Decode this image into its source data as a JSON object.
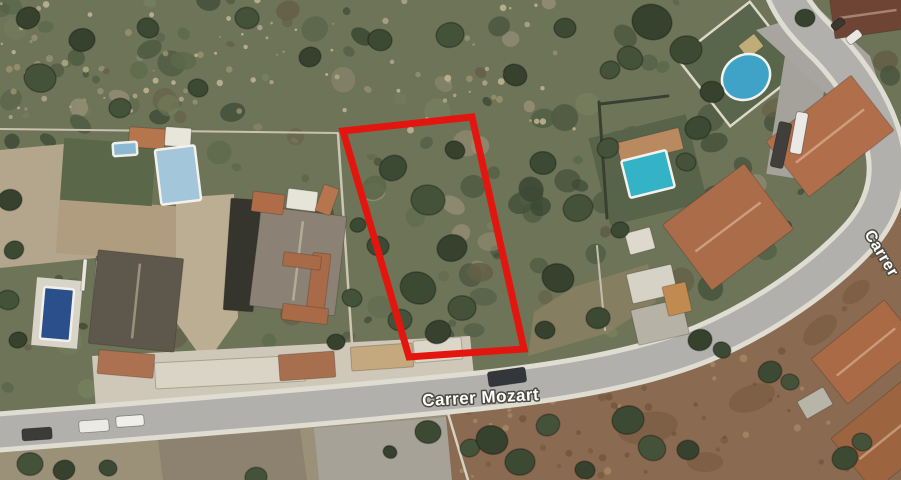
{
  "view": {
    "type": "satellite map view",
    "width": 901,
    "height": 480
  },
  "labels": {
    "road_main": "Carrer Mozart",
    "road_side": "Carrer"
  },
  "palette": {
    "base": "#6e7458",
    "road_fill": "#b1b0ac",
    "road_casing": "#dfdcd2",
    "red_outline": "#e3160f",
    "label_fill": "#ffffff",
    "label_halo": "#4d4a42",
    "blotch": "#6f5539",
    "tree_shades": [
      "#3c4a33",
      "#44523a",
      "#36422e"
    ]
  },
  "texture": {
    "seed": 11,
    "green_blobs": 260,
    "green_palette": [
      "#4e5c42",
      "#45523b",
      "#5b6949",
      "#3b4834",
      "#76805e",
      "#9a9177",
      "#645f47"
    ],
    "rock_speckles": 95,
    "rock_palette": [
      "#b3a78a",
      "#c3b697",
      "#99906f"
    ],
    "dirt_speckles": 85,
    "dirt_palette": [
      "#755a3e",
      "#a98d67",
      "#6d5338"
    ]
  },
  "grounds": [
    {
      "name": "courtyard-left-edge",
      "poly": [
        [
          0,
          150
        ],
        [
          86,
          142
        ],
        [
          96,
          258
        ],
        [
          0,
          268
        ]
      ],
      "fill": "#b3a68c"
    },
    {
      "name": "courtyard-left",
      "rect": [
        120,
        230,
        125,
        55,
        4
      ],
      "fill": "#b09d7f"
    },
    {
      "name": "courtyard-center",
      "poly": [
        [
          176,
          198
        ],
        [
          234,
          194
        ],
        [
          238,
          318
        ],
        [
          206,
          364
        ],
        [
          176,
          322
        ]
      ],
      "fill": "#bcae93"
    },
    {
      "name": "pool-deck-left",
      "rect": [
        57,
        313,
        46,
        68,
        5
      ],
      "fill": "#d8d4c8"
    },
    {
      "name": "lawn-left",
      "rect": [
        108,
        172,
        92,
        62,
        4
      ],
      "fill": "#5a6849"
    },
    {
      "name": "garden-teal-pool",
      "rect": [
        648,
        170,
        100,
        90,
        -14
      ],
      "fill": "#57644a"
    },
    {
      "name": "garden-oval-pool",
      "rect": [
        740,
        64,
        92,
        86,
        -38
      ],
      "fill": "#59664b",
      "stroke": "#ddd8c8",
      "stroke_w": 2.5
    },
    {
      "name": "band-north-of-road",
      "poly": [
        [
          92,
          356
        ],
        [
          470,
          336
        ],
        [
          476,
          396
        ],
        [
          96,
          410
        ]
      ],
      "fill": "#cfc8b8"
    },
    {
      "name": "dirt-south-left",
      "poly": [
        [
          0,
          452
        ],
        [
          155,
          437
        ],
        [
          312,
          426
        ],
        [
          470,
          410
        ],
        [
          505,
          480
        ],
        [
          0,
          480
        ]
      ],
      "fill": "#9b9078"
    },
    {
      "name": "plot-dirt-brown",
      "poly": [
        [
          158,
          440
        ],
        [
          300,
          429
        ],
        [
          307,
          480
        ],
        [
          163,
          480
        ]
      ],
      "fill": "#8d8170"
    },
    {
      "name": "plot-gray",
      "poly": [
        [
          314,
          428
        ],
        [
          446,
          417
        ],
        [
          452,
          480
        ],
        [
          319,
          480
        ]
      ],
      "fill": "#a6a298"
    },
    {
      "name": "dirt-bottom-right",
      "poly": [
        [
          446,
          416
        ],
        [
          540,
          392
        ],
        [
          640,
          370
        ],
        [
          730,
          330
        ],
        [
          800,
          290
        ],
        [
          862,
          232
        ],
        [
          901,
          196
        ],
        [
          901,
          480
        ],
        [
          452,
          480
        ]
      ],
      "fill": "#8a6a50"
    },
    {
      "name": "dirt-mid-right",
      "poly": [
        [
          528,
          356
        ],
        [
          608,
          333
        ],
        [
          656,
          302
        ],
        [
          648,
          264
        ],
        [
          574,
          287
        ],
        [
          534,
          312
        ]
      ],
      "fill": "#8d8163",
      "opacity": 0.75
    },
    {
      "name": "pave-right-strip",
      "rect": [
        799,
        108,
        44,
        140,
        9
      ],
      "fill": "#a5a29b"
    },
    {
      "name": "pave-top-right",
      "poly": [
        [
          756,
          30
        ],
        [
          820,
          10
        ],
        [
          870,
          56
        ],
        [
          884,
          100
        ],
        [
          856,
          120
        ],
        [
          800,
          70
        ]
      ],
      "fill": "#a8a5a0"
    }
  ],
  "walls": [
    {
      "name": "wall-top-left",
      "d": "M 0 129 L 338 133",
      "color": "#c9c2b0",
      "w": 2
    },
    {
      "name": "wall-plot-west",
      "d": "M 338 134 L 352 344",
      "color": "#ccc5b2",
      "w": 2.5
    },
    {
      "name": "hedge-right-vert",
      "d": "M 599 102 L 607 218",
      "color": "#39402f",
      "w": 3
    },
    {
      "name": "hedge-right-horiz",
      "d": "M 600 104 L 668 96",
      "color": "#39402f",
      "w": 3
    },
    {
      "name": "wall-mid-right",
      "d": "M 597 246 L 605 330",
      "color": "#c5beac",
      "w": 2
    },
    {
      "name": "wall-bottom-center",
      "d": "M 447 410 L 468 480",
      "color": "#d6d1c4",
      "w": 2.5
    }
  ],
  "road": {
    "d": "M -14 433 C 140 421, 320 407, 478 391 C 560 382, 640 369, 702 344 C 764 318, 824 276, 860 236 C 888 204, 894 168, 880 130 C 868 96, 844 62, 818 38 C 804 24, 792 10, 784 -10",
    "casing_w": 41,
    "fill_w": 31
  },
  "buildings": [
    [
      "roof-terracotta-top1",
      147,
      138,
      36,
      20,
      4,
      "#b5764e",
      0
    ],
    [
      "roof-white-top1",
      178,
      137,
      26,
      19,
      4,
      "#e8e5da",
      0
    ],
    [
      "driveway-dark",
      242,
      255,
      30,
      112,
      4,
      "#35352d",
      0
    ],
    [
      "roof-graybrown-main",
      298,
      261,
      86,
      100,
      7,
      "#8b8174",
      1
    ],
    [
      "roof-terracotta-L1",
      318,
      287,
      18,
      68,
      7,
      "#a96a47",
      0
    ],
    [
      "roof-terracotta-L2",
      305,
      314,
      46,
      16,
      7,
      "#a96a47",
      0
    ],
    [
      "roof-terracotta-L3",
      302,
      261,
      38,
      14,
      7,
      "#a96a47",
      0
    ],
    [
      "roof-terracotta-s2",
      268,
      203,
      32,
      20,
      7,
      "#b06c48",
      0
    ],
    [
      "roof-white-s2",
      302,
      200,
      30,
      20,
      7,
      "#e6e3d8",
      0
    ],
    [
      "roof-terracotta-s3",
      327,
      200,
      16,
      28,
      20,
      "#b5764e",
      0
    ],
    [
      "pergola-slat",
      84,
      275,
      4,
      32,
      5,
      "#e9e6dc",
      0
    ],
    [
      "pergola-slat",
      97,
      276,
      4,
      32,
      5,
      "#e9e6dc",
      0
    ],
    [
      "pergola-slat",
      110,
      277,
      4,
      32,
      5,
      "#e9e6dc",
      0
    ],
    [
      "pergola-slat",
      123,
      278,
      4,
      32,
      5,
      "#e9e6dc",
      0
    ],
    [
      "pergola-slat",
      136,
      279,
      4,
      32,
      5,
      "#e9e6dc",
      0
    ],
    [
      "roof-dark-left",
      136,
      301,
      86,
      94,
      6,
      "#5e574b",
      1
    ],
    [
      "roof-terracotta-strip",
      126,
      364,
      56,
      24,
      5,
      "#ab7150",
      0
    ],
    [
      "roof-white-band",
      230,
      372,
      150,
      26,
      -3,
      "#d9d4c6",
      0
    ],
    [
      "roof-terracotta-b1",
      307,
      366,
      56,
      26,
      -4,
      "#a86f4e",
      0
    ],
    [
      "roof-tan-b1",
      382,
      357,
      62,
      24,
      -4,
      "#c4a87e",
      0
    ],
    [
      "roof-white-b2",
      438,
      350,
      48,
      22,
      -5,
      "#dcd7c9",
      0
    ],
    [
      "roof-tan-pool-house",
      650,
      146,
      64,
      22,
      -14,
      "#b98960",
      0
    ],
    [
      "roof-white-shed",
      640,
      241,
      26,
      22,
      -15,
      "#ddd9cc",
      0
    ],
    [
      "roof-hip-main",
      728,
      227,
      102,
      82,
      -37,
      "#ab6c49",
      1
    ],
    [
      "slab-white",
      652,
      284,
      46,
      30,
      -13,
      "#d6d2c6",
      0
    ],
    [
      "slab-gray",
      660,
      322,
      52,
      36,
      -13,
      "#b7b2a6",
      0
    ],
    [
      "roof-orange-small",
      677,
      299,
      24,
      30,
      -13,
      "#c08a50",
      0
    ],
    [
      "roof-big-terracotta",
      830,
      136,
      108,
      70,
      -38,
      "#b06f4a",
      1
    ],
    [
      "roof-dark-topright",
      868,
      14,
      72,
      40,
      -8,
      "#6e4434",
      1
    ],
    [
      "shed-tan-topright",
      751,
      46,
      20,
      16,
      -38,
      "#c0ac76",
      0
    ],
    [
      "roof-terra-br1",
      866,
      352,
      94,
      58,
      -39,
      "#a96a45",
      1
    ],
    [
      "roof-terra-br2",
      888,
      436,
      92,
      68,
      -39,
      "#9d6440",
      1
    ],
    [
      "shed-gray-br",
      815,
      403,
      30,
      20,
      -30,
      "#b8b4a8",
      0
    ]
  ],
  "pools": [
    [
      "pool-left-large",
      "rect",
      178,
      175,
      40,
      55,
      -7,
      "#a4c6da",
      "#f2f1ec"
    ],
    [
      "pool-left-small",
      "rect",
      125,
      149,
      24,
      13,
      -4,
      "#8bb8d2",
      "#eef0ea"
    ],
    [
      "pool-left-deep",
      "rect",
      57,
      314,
      30,
      52,
      5,
      "#2a4f8a",
      "#f0efe9"
    ],
    [
      "pool-teal",
      "rect",
      648,
      174,
      46,
      38,
      -14,
      "#35b3c6",
      "#f2f1ec"
    ],
    [
      "pool-oval",
      "ellipse",
      746,
      77,
      50,
      44,
      -35,
      "#3fa3c8",
      "#f2f1ec"
    ]
  ],
  "trees": [
    [
      393,
      168,
      14
    ],
    [
      428,
      200,
      17
    ],
    [
      452,
      248,
      15
    ],
    [
      418,
      288,
      18
    ],
    [
      462,
      308,
      14
    ],
    [
      438,
      332,
      13
    ],
    [
      378,
      246,
      11
    ],
    [
      400,
      320,
      12
    ],
    [
      455,
      150,
      10
    ],
    [
      543,
      163,
      13
    ],
    [
      578,
      208,
      15
    ],
    [
      558,
      278,
      16
    ],
    [
      598,
      318,
      12
    ],
    [
      608,
      148,
      11
    ],
    [
      545,
      330,
      10
    ],
    [
      620,
      230,
      9
    ],
    [
      352,
      298,
      10
    ],
    [
      336,
      342,
      9
    ],
    [
      358,
      225,
      8
    ],
    [
      40,
      78,
      16
    ],
    [
      82,
      40,
      13
    ],
    [
      148,
      28,
      11
    ],
    [
      247,
      18,
      12
    ],
    [
      310,
      57,
      11
    ],
    [
      198,
      88,
      10
    ],
    [
      120,
      108,
      11
    ],
    [
      28,
      18,
      12
    ],
    [
      380,
      40,
      12
    ],
    [
      450,
      35,
      14
    ],
    [
      515,
      75,
      12
    ],
    [
      565,
      28,
      11
    ],
    [
      610,
      70,
      10
    ],
    [
      652,
      22,
      20
    ],
    [
      686,
      50,
      16
    ],
    [
      630,
      58,
      13
    ],
    [
      712,
      92,
      12
    ],
    [
      698,
      128,
      13
    ],
    [
      686,
      162,
      10
    ],
    [
      805,
      18,
      10
    ],
    [
      770,
      372,
      12
    ],
    [
      790,
      382,
      9
    ],
    [
      700,
      340,
      12
    ],
    [
      722,
      350,
      9
    ],
    [
      30,
      464,
      13
    ],
    [
      64,
      470,
      11
    ],
    [
      108,
      468,
      9
    ],
    [
      256,
      477,
      11
    ],
    [
      390,
      452,
      7
    ],
    [
      428,
      432,
      13
    ],
    [
      470,
      448,
      10
    ],
    [
      492,
      440,
      16
    ],
    [
      520,
      462,
      15
    ],
    [
      548,
      425,
      12
    ],
    [
      585,
      470,
      10
    ],
    [
      628,
      420,
      16
    ],
    [
      652,
      448,
      14
    ],
    [
      688,
      450,
      11
    ],
    [
      845,
      458,
      13
    ],
    [
      862,
      442,
      10
    ],
    [
      10,
      200,
      12
    ],
    [
      14,
      250,
      10
    ],
    [
      8,
      300,
      11
    ],
    [
      18,
      340,
      9
    ]
  ],
  "blotches": [
    [
      648,
      428,
      30,
      16,
      -10
    ],
    [
      752,
      398,
      24,
      13,
      -20
    ],
    [
      705,
      462,
      18,
      10,
      0
    ],
    [
      856,
      292,
      16,
      9,
      -40
    ],
    [
      820,
      330,
      20,
      11,
      -40
    ]
  ],
  "vehicles": [
    [
      37,
      434,
      30,
      12,
      -4,
      "#3b3b38"
    ],
    [
      94,
      426,
      30,
      12,
      -4,
      "#eceae4"
    ],
    [
      130,
      421,
      28,
      11,
      -4,
      "#f1efe9"
    ],
    [
      507,
      377,
      38,
      15,
      -8,
      "#33363a"
    ],
    [
      781,
      145,
      13,
      46,
      12,
      "#403f3b"
    ],
    [
      799,
      133,
      12,
      42,
      10,
      "#eae9e5"
    ],
    [
      854,
      37,
      16,
      9,
      -38,
      "#e8e7e2"
    ],
    [
      838,
      24,
      14,
      8,
      -38,
      "#38382f"
    ]
  ],
  "street_labels": [
    {
      "bind": "labels.road_main",
      "x": 481,
      "y": 403,
      "rot": -3,
      "size": 17,
      "anchor": "middle",
      "spacing": 0.5
    },
    {
      "bind": "labels.road_side",
      "x": 864,
      "y": 234,
      "rot": 59,
      "size": 16,
      "anchor": "start",
      "spacing": 0.5
    }
  ],
  "plot_outline": {
    "points": [
      [
        343,
        131
      ],
      [
        472,
        117
      ],
      [
        524,
        349
      ],
      [
        409,
        357
      ]
    ],
    "color": "#e3160f",
    "width": 7
  }
}
